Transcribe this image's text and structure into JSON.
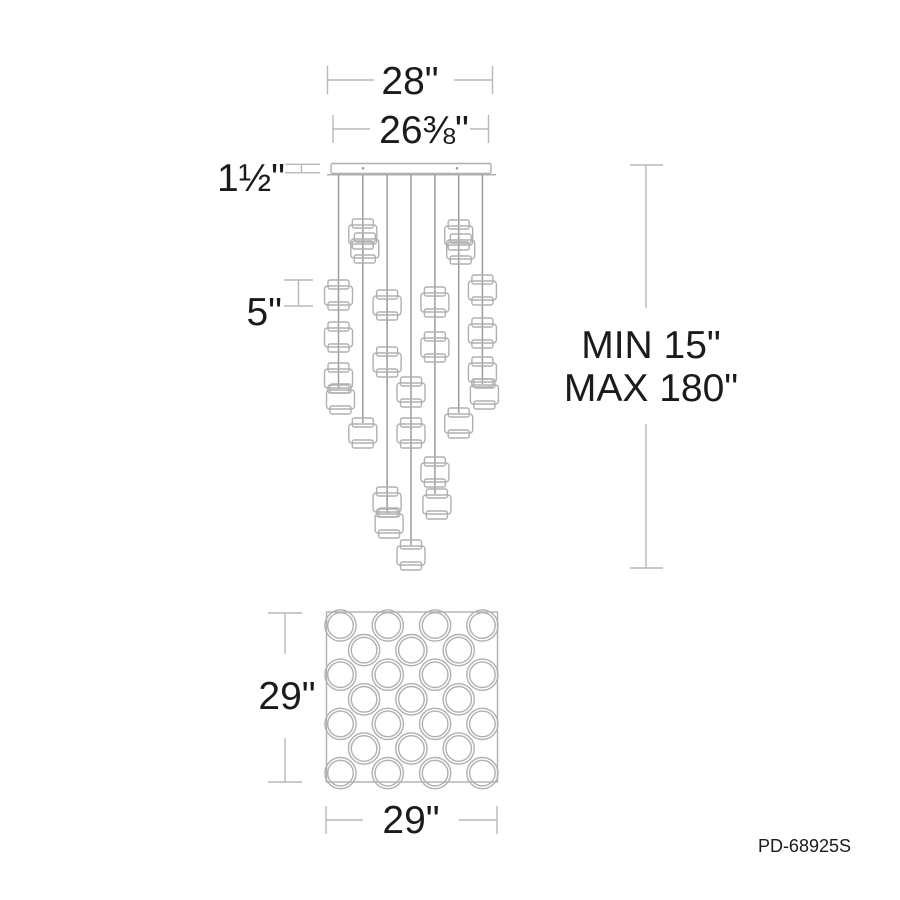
{
  "product": {
    "part_number": "PD-68925S",
    "pendant_count": 25,
    "drawing_type": "pendant-fixture-spec-diagram"
  },
  "labels": {
    "width_overall": "28\"",
    "width_canopy": "26⅜\"",
    "canopy_height": "1½\"",
    "shade_height": "5\"",
    "suspension_min": "MIN 15\"",
    "suspension_max": "MAX 180\"",
    "canopy_depth": "29\"",
    "canopy_width": "29\"",
    "part_number": "PD-68925S"
  },
  "colors": {
    "dim_line": "#b8b8b8",
    "outline": "#b0b0b0",
    "rod": "#9b9b9b",
    "text": "#1b1b1b",
    "background": "#ffffff"
  },
  "fixture": {
    "canopy_bar": {
      "x": 331,
      "y": 163.5,
      "w": 160,
      "h": 10
    },
    "canopy_plate": {
      "x1": 327,
      "x2": 496,
      "y": 174.8
    },
    "screws": [
      {
        "x": 363,
        "y": 168.3
      },
      {
        "x": 457,
        "y": 168.3
      }
    ],
    "rod_top_y": 175,
    "drum": {
      "band_w": 21,
      "band_h": 9,
      "body_w": 28,
      "body_h": 19,
      "body_dy": 6,
      "bot_w": 21,
      "bot_h": 8,
      "bot_dy": 22
    },
    "rods": [
      {
        "x": 338.5,
        "end": 389,
        "drums": [
          {
            "y": 280
          },
          {
            "y": 322
          },
          {
            "y": 363
          },
          {
            "y": 384,
            "dx": 2
          }
        ]
      },
      {
        "x": 362.8,
        "end": 423,
        "drums": [
          {
            "y": 219
          },
          {
            "y": 233,
            "dx": 2
          },
          {
            "y": 418
          }
        ]
      },
      {
        "x": 387.1,
        "end": 513,
        "drums": [
          {
            "y": 290
          },
          {
            "y": 347
          },
          {
            "y": 487
          },
          {
            "y": 508,
            "dx": 2
          }
        ]
      },
      {
        "x": 411.0,
        "end": 545,
        "drums": [
          {
            "y": 377
          },
          {
            "y": 418
          },
          {
            "y": 540
          }
        ]
      },
      {
        "x": 434.9,
        "end": 494,
        "drums": [
          {
            "y": 287
          },
          {
            "y": 332
          },
          {
            "y": 457
          },
          {
            "y": 489,
            "dx": 2
          }
        ]
      },
      {
        "x": 458.7,
        "end": 413,
        "drums": [
          {
            "y": 220
          },
          {
            "y": 234,
            "dx": 2
          },
          {
            "y": 408
          }
        ]
      },
      {
        "x": 482.4,
        "end": 384,
        "drums": [
          {
            "y": 275
          },
          {
            "y": 318
          },
          {
            "y": 357
          },
          {
            "y": 379,
            "dx": 2
          }
        ]
      }
    ]
  },
  "top_view": {
    "square": {
      "x": 326.5,
      "y": 612,
      "w": 171,
      "h": 170
    },
    "circle_outer_r": 15.6,
    "circle_inner_r": 12.8,
    "row_ys": [
      625.5,
      650.1,
      674.7,
      699.3,
      723.9,
      748.5,
      773.1
    ],
    "row4_xs": [
      340.5,
      387.8,
      435.1,
      482.4
    ],
    "row3_xs": [
      364.1,
      411.4,
      458.7
    ]
  },
  "dim_geometry": {
    "stroke_w": 1.4,
    "lines": [
      {
        "name": "dim-28",
        "segs": [
          [
            327.5,
            80,
            374,
            80
          ],
          [
            454,
            80,
            492.5,
            80
          ],
          [
            327.5,
            66,
            327.5,
            94
          ],
          [
            492.5,
            66,
            492.5,
            94
          ]
        ]
      },
      {
        "name": "dim-26-38",
        "segs": [
          [
            333,
            129,
            370,
            129
          ],
          [
            470,
            129,
            488.5,
            129
          ],
          [
            333,
            115,
            333,
            143
          ],
          [
            488.5,
            115,
            488.5,
            143
          ]
        ]
      },
      {
        "name": "dim-1-5",
        "segs": [
          [
            285,
            164.3,
            320,
            164.3
          ],
          [
            285,
            172.8,
            320,
            172.8
          ],
          [
            301.5,
            164.3,
            301.5,
            172.8
          ]
        ]
      },
      {
        "name": "dim-5",
        "segs": [
          [
            284,
            280,
            313,
            280
          ],
          [
            284,
            306,
            313,
            306
          ],
          [
            298.5,
            280,
            298.5,
            306
          ]
        ]
      },
      {
        "name": "dim-min-max",
        "segs": [
          [
            630,
            165,
            663,
            165
          ],
          [
            630,
            568,
            663,
            568
          ],
          [
            646,
            165,
            646,
            308
          ],
          [
            646,
            424,
            646,
            568
          ]
        ]
      },
      {
        "name": "dim-29-left",
        "segs": [
          [
            268,
            613,
            302,
            613
          ],
          [
            268,
            782,
            302,
            782
          ],
          [
            285,
            613,
            285,
            654
          ],
          [
            285,
            738,
            285,
            782
          ]
        ]
      },
      {
        "name": "dim-29-bottom",
        "segs": [
          [
            326,
            806,
            326,
            834
          ],
          [
            497,
            806,
            497,
            834
          ],
          [
            326,
            820,
            363,
            820
          ],
          [
            459,
            820,
            497,
            820
          ]
        ]
      }
    ]
  }
}
